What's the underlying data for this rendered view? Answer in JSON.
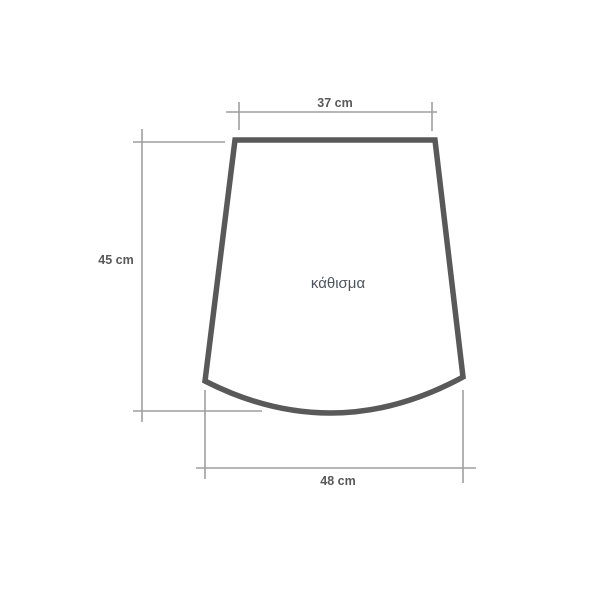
{
  "diagram": {
    "shape_label": "κάθισμα",
    "dimensions": {
      "top": {
        "label": "37 cm",
        "value_cm": 37
      },
      "left": {
        "label": "45 cm",
        "value_cm": 45
      },
      "bottom": {
        "label": "48 cm",
        "value_cm": 48
      }
    },
    "colors": {
      "background": "#ffffff",
      "shape_stroke": "#595959",
      "dimension_line": "#9e9e9e",
      "dimension_text": "#595959",
      "shape_label_text": "#4d5360"
    }
  }
}
